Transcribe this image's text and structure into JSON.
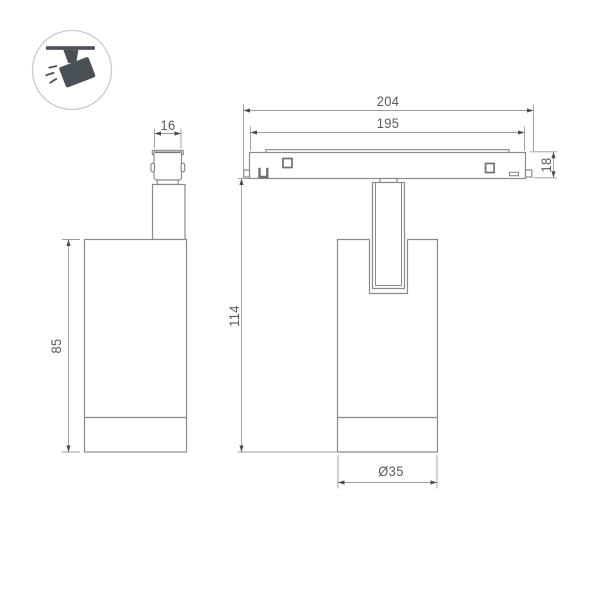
{
  "logo": {
    "icon": "track-spotlight-icon",
    "color": "#4a5156",
    "circle_border_color": "#c8cacb"
  },
  "drawing": {
    "type": "technical-dimension-drawing",
    "subject": "magnetic track spotlight",
    "line_color": "#8a8a8a",
    "detail_line_color": "#6d7073",
    "dim_line_color": "#9b9b9b",
    "arrow_color": "#4c4e50",
    "text_color": "#595a5c",
    "background_color": "#ffffff"
  },
  "dimensions": {
    "side_view": {
      "connector_width": "16",
      "body_height": "85"
    },
    "front_view": {
      "total_length": "204",
      "rail_length": "195",
      "rail_height": "18",
      "overall_height": "114",
      "body_diameter": "Ø35"
    }
  }
}
